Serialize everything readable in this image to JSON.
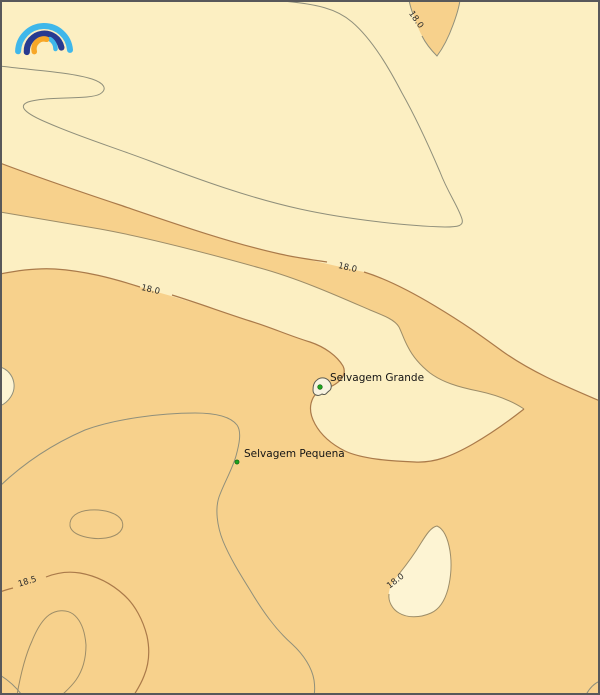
{
  "islands": [
    {
      "name": "Selvagem Grande"
    },
    {
      "name": "Selvagem Pequena"
    }
  ],
  "contour_labels": [
    {
      "text": "18.0"
    },
    {
      "text": "18.0"
    },
    {
      "text": "18.0"
    },
    {
      "text": "18.5"
    },
    {
      "text": "18.0"
    }
  ],
  "contour_levels": [
    "18.0",
    "18.5"
  ],
  "colors": {
    "cream": "#fcefc2",
    "pale_cream": "#fdf4d3",
    "orange": "#f7d18c",
    "contour_gray": "#8f8f7b",
    "contour_brown": "#aa7a4a",
    "marker_green": "#1fa41f",
    "frame": "#58585a",
    "logo_light_blue": "#3fb7ea",
    "logo_dark_blue": "#283a90",
    "logo_orange": "#f7a728"
  }
}
